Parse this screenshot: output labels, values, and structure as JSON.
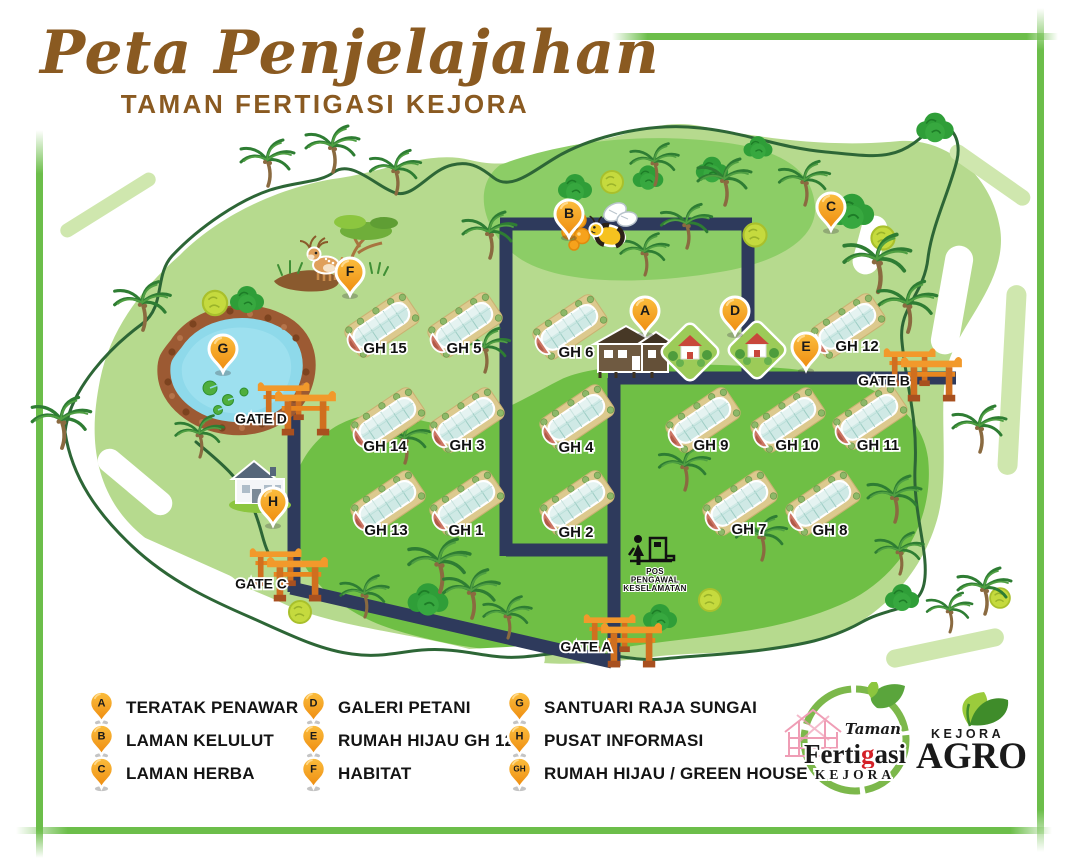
{
  "title": {
    "main": "Peta Penjelajahan",
    "subtitle": "TAMAN FERTIGASI KEJORA"
  },
  "colors": {
    "frame_green": "#6cbe4a",
    "park_light": "#b6da8e",
    "park_medium": "#6fbf45",
    "boundary_green": "#2d6636",
    "road_navy": "#2e3a5c",
    "pin_orange": "#f5a01b",
    "torii_orange": "#e8861f",
    "title_brown": "#8a5a21",
    "pond_water": "#8ed9ea"
  },
  "map": {
    "greenhouses": [
      {
        "label": "GH 15",
        "x": 382,
        "y": 325,
        "lx": 385,
        "ly": 349
      },
      {
        "label": "GH 5",
        "x": 465,
        "y": 325,
        "lx": 464,
        "ly": 349
      },
      {
        "label": "GH 6",
        "x": 570,
        "y": 327,
        "lx": 576,
        "ly": 353
      },
      {
        "label": "GH 14",
        "x": 388,
        "y": 420,
        "lx": 385,
        "ly": 447
      },
      {
        "label": "GH 3",
        "x": 467,
        "y": 420,
        "lx": 467,
        "ly": 446
      },
      {
        "label": "GH 4",
        "x": 577,
        "y": 417,
        "lx": 576,
        "ly": 448
      },
      {
        "label": "GH 13",
        "x": 388,
        "y": 503,
        "lx": 386,
        "ly": 531
      },
      {
        "label": "GH 1",
        "x": 467,
        "y": 503,
        "lx": 466,
        "ly": 531
      },
      {
        "label": "GH 2",
        "x": 577,
        "y": 503,
        "lx": 576,
        "ly": 533
      },
      {
        "label": "GH 9",
        "x": 703,
        "y": 420,
        "lx": 711,
        "ly": 446
      },
      {
        "label": "GH 10",
        "x": 788,
        "y": 420,
        "lx": 797,
        "ly": 446
      },
      {
        "label": "GH 11",
        "x": 870,
        "y": 417,
        "lx": 878,
        "ly": 446
      },
      {
        "label": "GH 7",
        "x": 740,
        "y": 503,
        "lx": 749,
        "ly": 530
      },
      {
        "label": "GH 8",
        "x": 823,
        "y": 503,
        "lx": 830,
        "ly": 531
      },
      {
        "label": "GH 12",
        "x": 848,
        "y": 326,
        "lx": 857,
        "ly": 347
      }
    ],
    "gates": [
      {
        "label": "GATE A",
        "x": 622,
        "y": 638,
        "lx": 586,
        "ly": 648
      },
      {
        "label": "GATE B",
        "x": 922,
        "y": 372,
        "lx": 884,
        "ly": 382
      },
      {
        "label": "GATE C",
        "x": 288,
        "y": 572,
        "lx": 261,
        "ly": 585
      },
      {
        "label": "GATE D",
        "x": 296,
        "y": 406,
        "lx": 261,
        "ly": 420
      }
    ],
    "pins": [
      {
        "letter": "A",
        "x": 645,
        "y": 312
      },
      {
        "letter": "B",
        "x": 569,
        "y": 215
      },
      {
        "letter": "C",
        "x": 831,
        "y": 208
      },
      {
        "letter": "D",
        "x": 735,
        "y": 312
      },
      {
        "letter": "E",
        "x": 806,
        "y": 348
      },
      {
        "letter": "F",
        "x": 350,
        "y": 273
      },
      {
        "letter": "G",
        "x": 223,
        "y": 350
      },
      {
        "letter": "H",
        "x": 273,
        "y": 503
      }
    ],
    "guard_post": {
      "lines": [
        "POS",
        "PENGAWAL",
        "KESELAMATAN"
      ],
      "x": 655,
      "y": 572
    }
  },
  "legend": {
    "columns": [
      {
        "items": [
          {
            "icon": "A",
            "label": "TERATAK PENAWAR"
          },
          {
            "icon": "B",
            "label": "LAMAN KELULUT"
          },
          {
            "icon": "C",
            "label": "LAMAN HERBA"
          }
        ]
      },
      {
        "items": [
          {
            "icon": "D",
            "label": "GALERI PETANI"
          },
          {
            "icon": "E",
            "label": "RUMAH HIJAU GH 12"
          },
          {
            "icon": "F",
            "label": "HABITAT"
          }
        ]
      },
      {
        "items": [
          {
            "icon": "G",
            "label": "SANTUARI RAJA SUNGAI"
          },
          {
            "icon": "H",
            "label": "PUSAT INFORMASI"
          },
          {
            "icon": "GH",
            "label": "RUMAH HIJAU / GREEN HOUSE"
          }
        ]
      }
    ]
  },
  "logos": {
    "fertigasi": {
      "taman": "Taman",
      "word_prefix": "Ferti",
      "word_accent": "g",
      "word_suffix": "asi",
      "kejora": "KEJORA"
    },
    "agro": {
      "kejora": "KEJORA",
      "agro": "AGRO"
    }
  }
}
